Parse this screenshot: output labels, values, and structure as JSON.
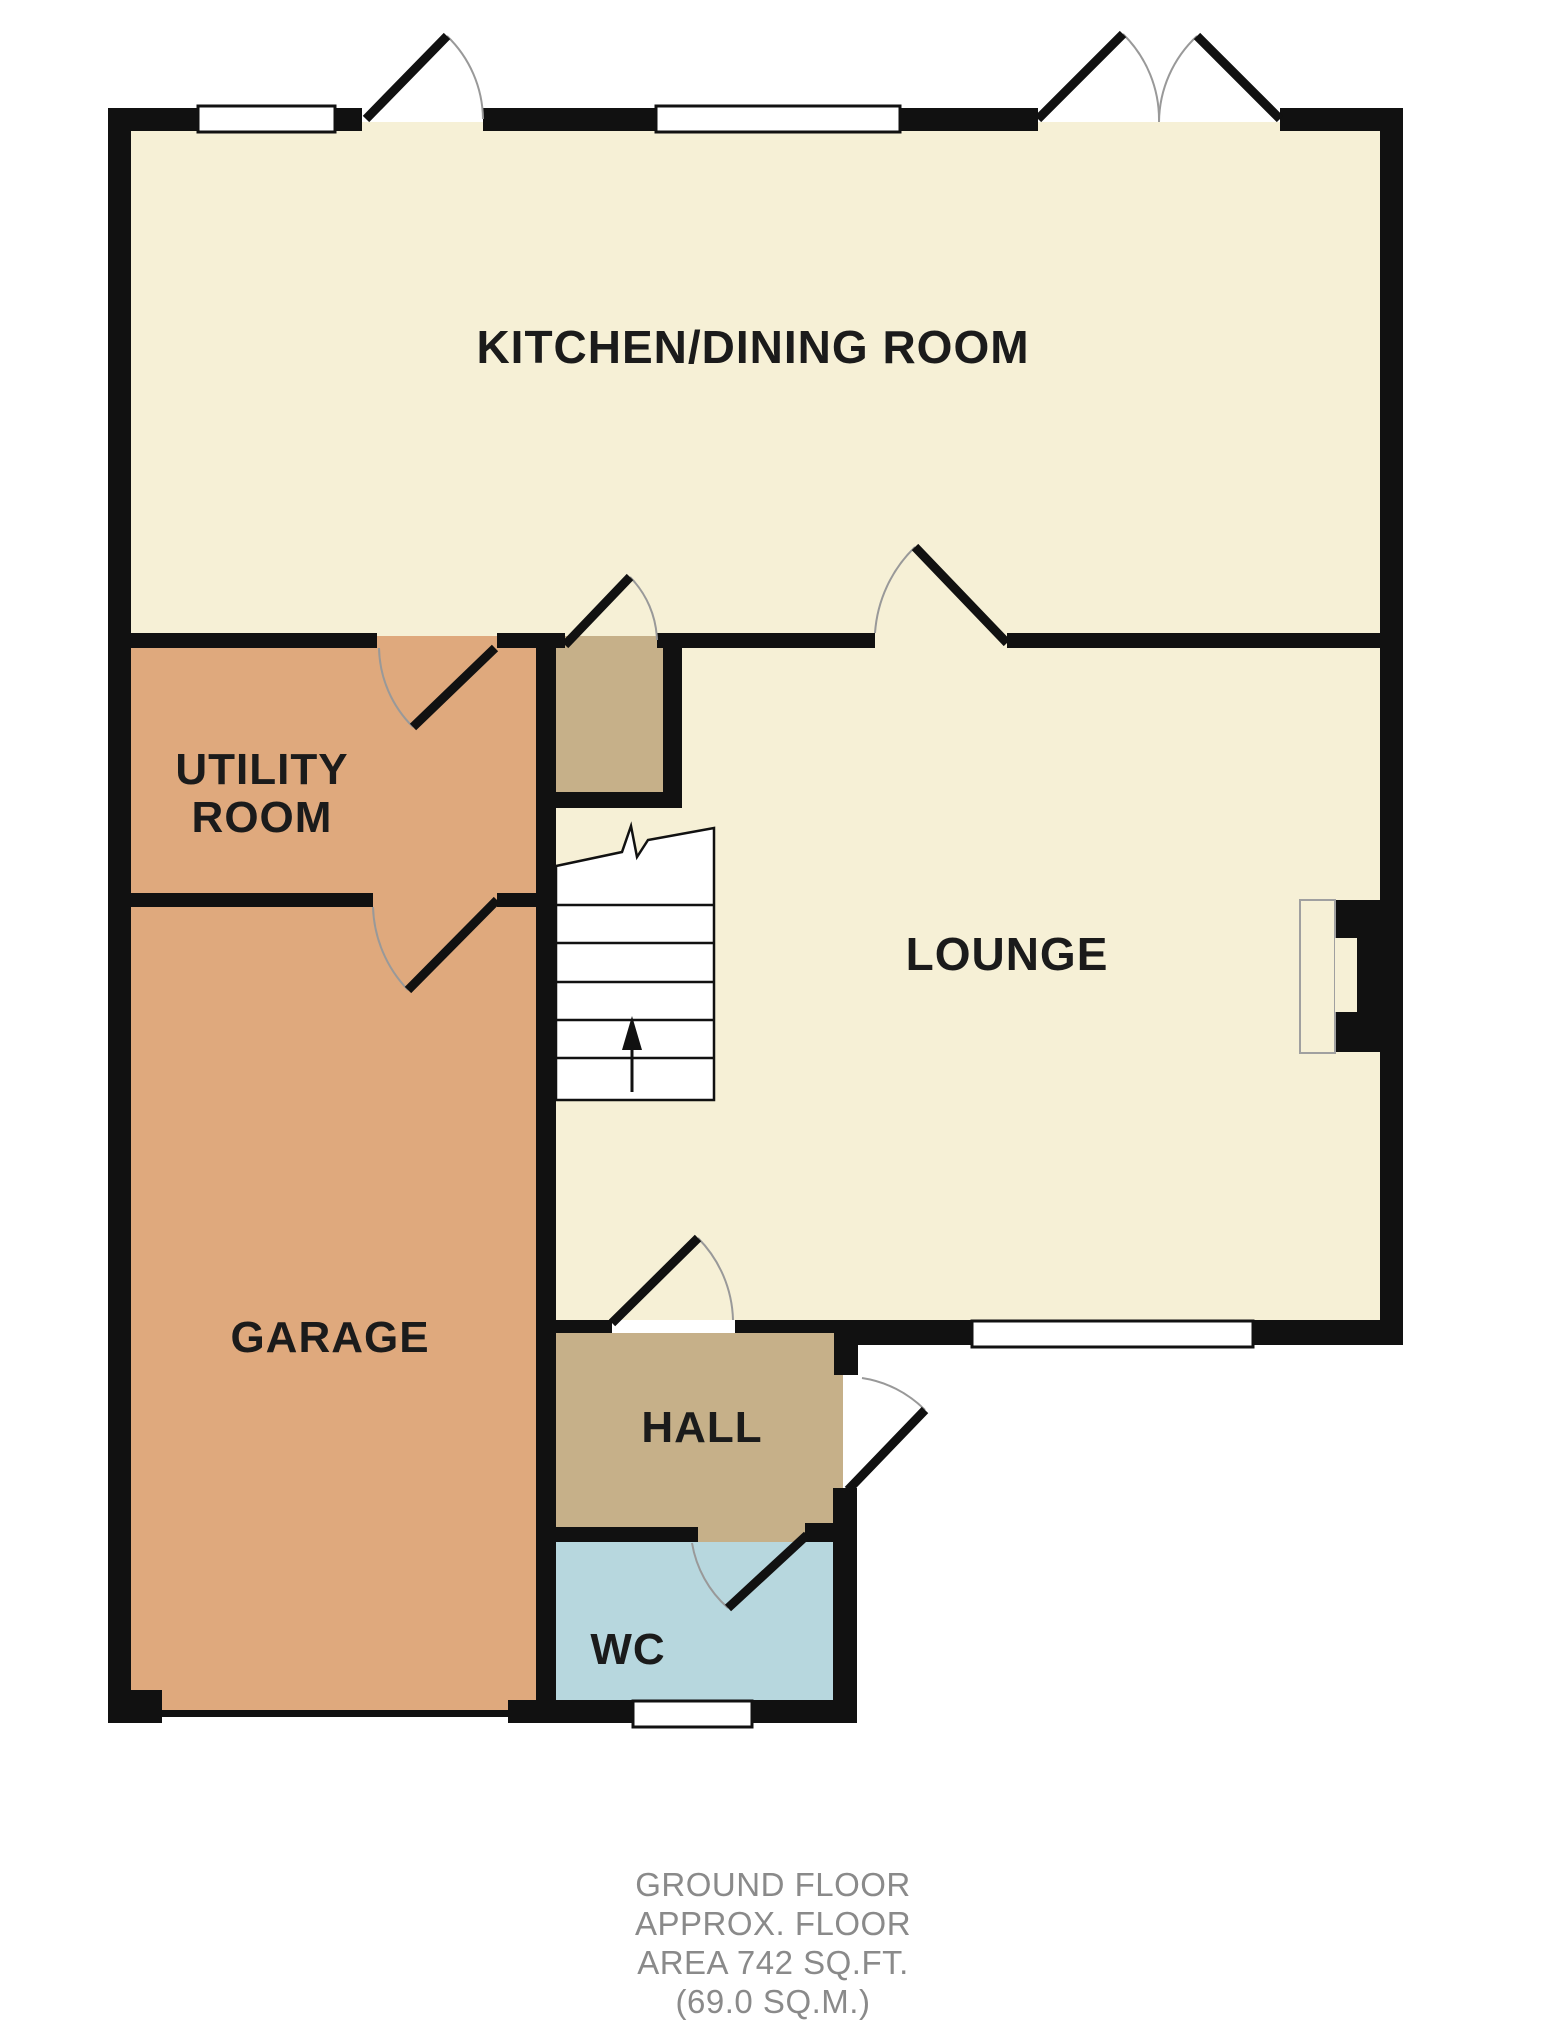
{
  "floorplan": {
    "title": "Ground floor plan",
    "rooms": {
      "kitchen": {
        "label": "KITCHEN/DINING ROOM"
      },
      "utility": {
        "label_line1": "UTILITY",
        "label_line2": "ROOM"
      },
      "lounge": {
        "label": "LOUNGE"
      },
      "garage": {
        "label": "GARAGE"
      },
      "hall": {
        "label": "HALL"
      },
      "wc": {
        "label": "WC"
      }
    },
    "footer": {
      "line1": "GROUND FLOOR",
      "line2": "APPROX. FLOOR",
      "line3": "AREA 742 SQ.FT.",
      "line4": "(69.0 SQ.M.)",
      "area_sqft": "742",
      "area_sqm": "69.0"
    },
    "colors": {
      "wall": "#111111",
      "room_cream": "#f6f0d6",
      "room_tan": "#dfa97d",
      "room_khaki": "#c6b089",
      "room_blue": "#b7d7de",
      "window_fill": "#ffffff",
      "door_arc": "#999999",
      "stair_outline": "#111111",
      "hearth_outline": "#a0a0a0",
      "label_text": "#1b1b1b",
      "footer_text": "#8a8a8a"
    }
  }
}
